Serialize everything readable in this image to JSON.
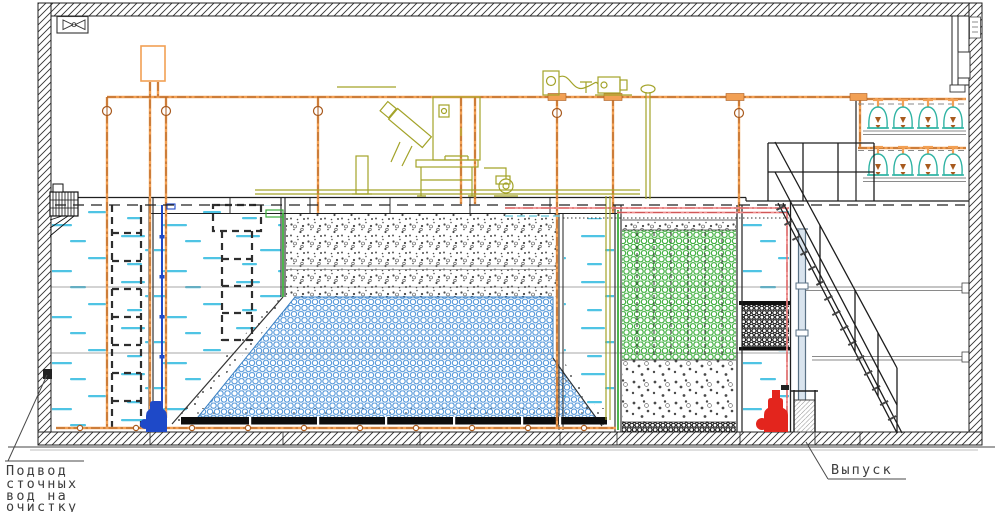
{
  "labels": {
    "inlet": {
      "line1": "Подвод",
      "line2": "сточных",
      "line3": "вод на",
      "line4": "очистку"
    },
    "outlet": "Выпуск"
  },
  "colors": {
    "wall-line": "#1f1f1f",
    "line": "#333333",
    "joint": "#8a8a8a",
    "pipe-orange": "#F2A054",
    "pipe-orange-dark": "#A85A1E",
    "pipe-pink": "#F09090",
    "pipe-pink-dark": "#D05858",
    "olive": "#A3A329",
    "water-dash": "#4FC4E4",
    "media-blue": "#4D93D8",
    "media-green": "#3BAE3B",
    "media-dark": "#161616",
    "gravel-dot": "#4a4a4a",
    "blower-teal": "#2FB3A3",
    "pump-red": "#E3251D",
    "pump-blue": "#1E49C8",
    "standpipe": "#5a7184",
    "label-text": "#3d3d3d"
  }
}
